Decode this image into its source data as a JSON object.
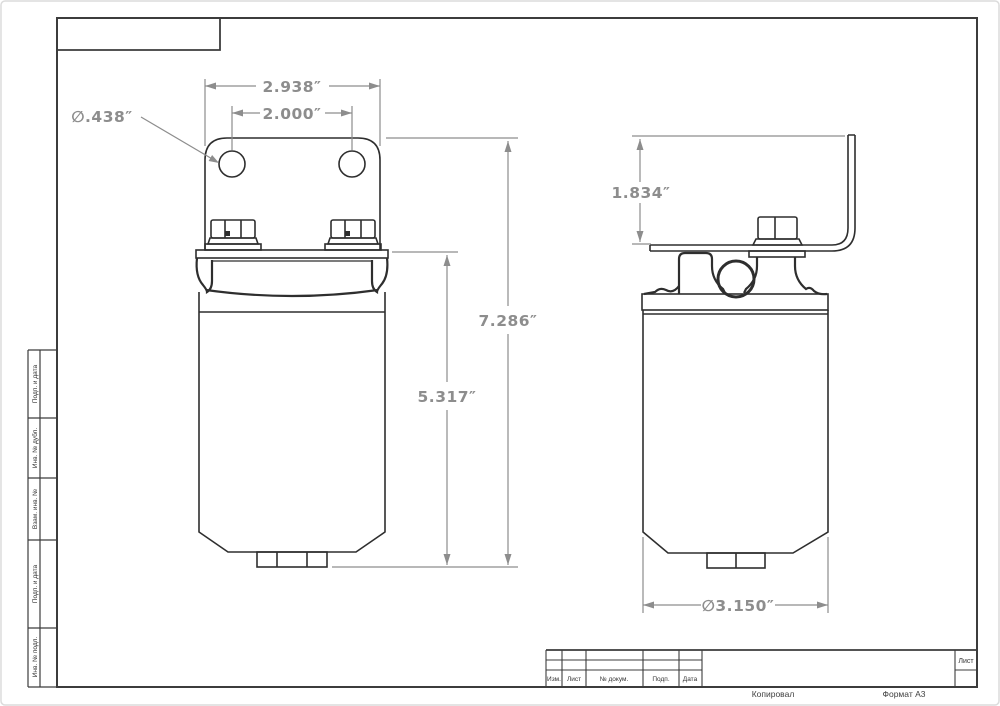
{
  "sheet": {
    "footer": {
      "copied": "Копировал",
      "format": "Формат A3"
    },
    "stamp": {
      "columns": [
        "Изм.",
        "Лист",
        "№ докум.",
        "Подп.",
        "Дата"
      ],
      "sheet_label": "Лист"
    },
    "side_column_labels": [
      "Подп. и дата",
      "Инв. № дубл.",
      "Взам. инв. №",
      "Подп. и дата",
      "Инв. № подл."
    ]
  },
  "dimensions": {
    "bracket_width": "2.938″",
    "hole_spacing": "2.000″",
    "hole_diameter": "∅.438″",
    "overall_height": "7.286″",
    "body_height": "5.317″",
    "bracket_height": "1.834″",
    "body_diameter": "∅3.150″"
  },
  "colors": {
    "part_line": "#2e2e2e",
    "dimension": "#8d8d8d",
    "frame": "#3c3c3c"
  }
}
